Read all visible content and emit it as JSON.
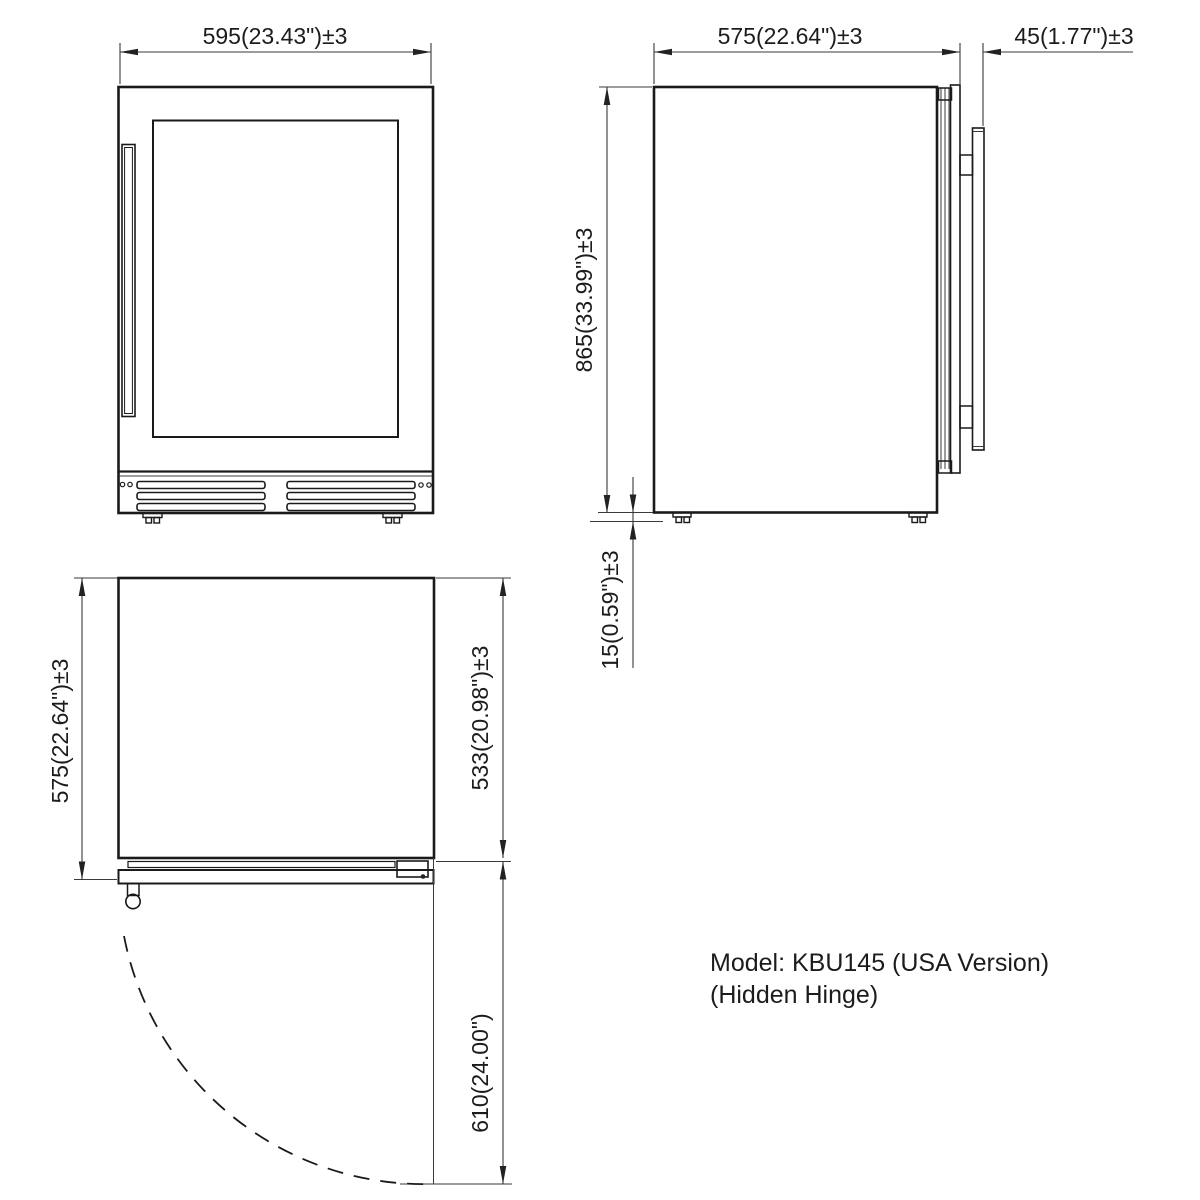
{
  "front_view": {
    "width_dim": "595(23.43\")±3"
  },
  "side_view": {
    "depth_dim": "575(22.64\")±3",
    "handle_dim": "45(1.77\")±3",
    "height_dim": "865(33.99\")±3",
    "foot_gap_dim": "15(0.59\")±3"
  },
  "top_view": {
    "total_depth_dim": "575(22.64\")±3",
    "body_depth_dim": "533(20.98\")±3",
    "door_swing_dim": "610(24.00\")"
  },
  "note": {
    "line1": "Model: KBU145 (USA Version)",
    "line2": "(Hidden Hinge)"
  }
}
